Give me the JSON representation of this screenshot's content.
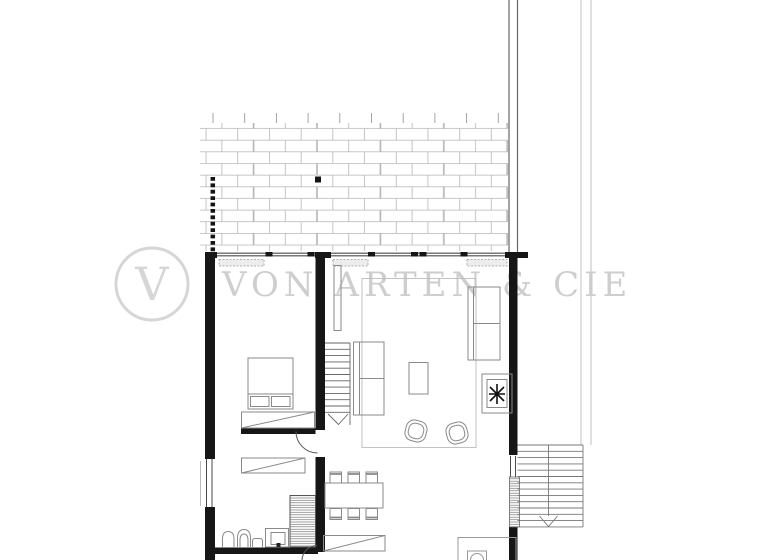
{
  "watermark": {
    "logo_letter": "V",
    "brand_text": "VON ARTEN & CIE"
  },
  "colors": {
    "background": "#ffffff",
    "wall_fill": "#161616",
    "thin_wall_line": "#4a4a4a",
    "furniture_line": "#8a8a8a",
    "rug_line": "#c2c2c2",
    "brick_line": "#b5b5b5",
    "watermark_gray": "#cccccc",
    "guide_light": "#cccccc",
    "guide_dark": "#666666",
    "sill_fill": "#ededed"
  },
  "plan": {
    "type": "architectural-floor-plan",
    "depicted_elements": [
      "brick-paved-terrace",
      "terrace-dotted-edge",
      "survey-point-square",
      "top-facade-windows",
      "bedroom",
      "double-bed",
      "wardrobe",
      "interior-staircase-down",
      "living-room",
      "rug-outline",
      "two-seat-sofa",
      "three-seat-sofa",
      "coffee-table",
      "armchairs",
      "plant-box",
      "dining-table-six-chairs",
      "sideboard",
      "wc-toilet",
      "wc-bidet",
      "washbasin-counter",
      "shower",
      "exterior-staircase-down",
      "utility-box-appliance",
      "property-guide-lines",
      "door-swing-arcs"
    ]
  }
}
